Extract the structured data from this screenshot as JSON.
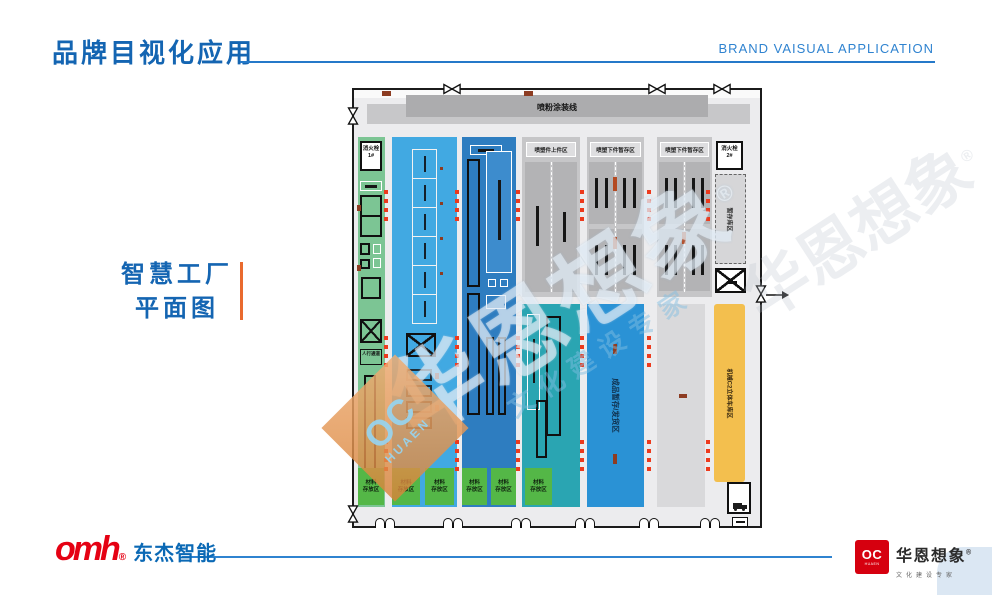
{
  "slide": {
    "title": "品牌目视化应用",
    "title_en": "BRAND VAISUAL APPLICATION",
    "caption_line1": "智慧工厂",
    "caption_line2": "平面图"
  },
  "colors": {
    "title_blue": "#1465b2",
    "rule_blue": "#2f83d0",
    "accent_orange": "#e96a2e",
    "dongjie_red": "#e50113",
    "huaen_red": "#d6000f"
  },
  "plan": {
    "paint_line": "喷粉涂装线",
    "hydrant1_line1": "消火栓",
    "hydrant1_line2": "1#",
    "hydrant2_line1": "消火栓",
    "hydrant2_line2": "2#",
    "walkway": "人行通道",
    "spray_load": "喷塑件上件区",
    "spray_unload1": "喷塑下件暂存区",
    "spray_unload2": "喷塑下件暂存区",
    "buffer": "暂存库区",
    "finished": "成品暂存/发货区",
    "machine_garage": "机械C2立体车库区",
    "material_line1": "材料",
    "material_line2": "存放区"
  },
  "watermark": {
    "main": "华恩想象",
    "reg": "®",
    "sub": "文化建设专家",
    "diamond_mark": "OC",
    "diamond_sub": "HUAEN"
  },
  "footer": {
    "dongjie": {
      "mark": "omh",
      "reg": "®",
      "name": "东杰智能"
    },
    "huaen": {
      "mark": "OC",
      "mark_sub": "HUAEN",
      "name": "华恩想象",
      "reg": "®",
      "tagline": "文化建设专家"
    }
  }
}
